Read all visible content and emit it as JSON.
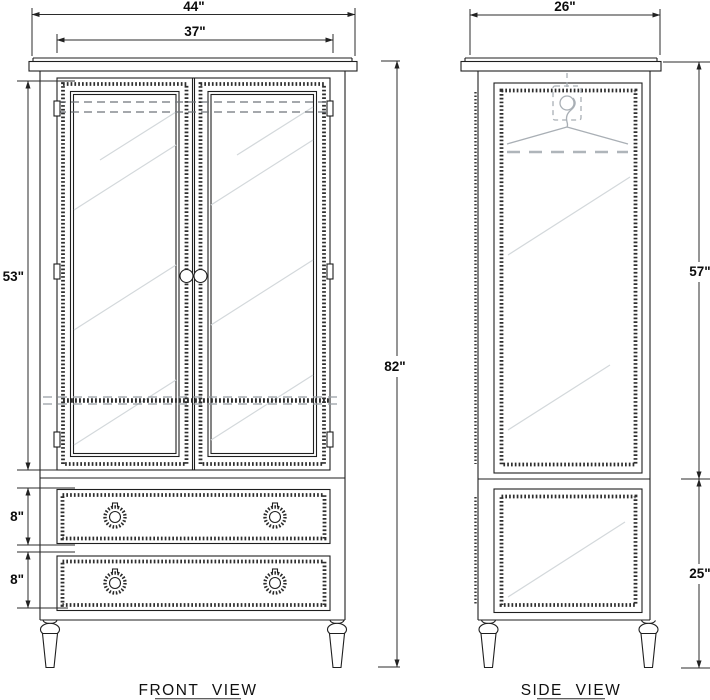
{
  "drawing": {
    "front_view": {
      "label": "FRONT VIEW",
      "dims": {
        "overall_width": "44\"",
        "doors_width": "37\"",
        "doors_height": "53\"",
        "drawer1_height": "8\"",
        "drawer2_height": "8\"",
        "overall_height": "82\""
      }
    },
    "side_view": {
      "label": "SIDE VIEW",
      "dims": {
        "depth": "26\"",
        "upper_height": "57\"",
        "lower_height": "25\""
      }
    }
  }
}
